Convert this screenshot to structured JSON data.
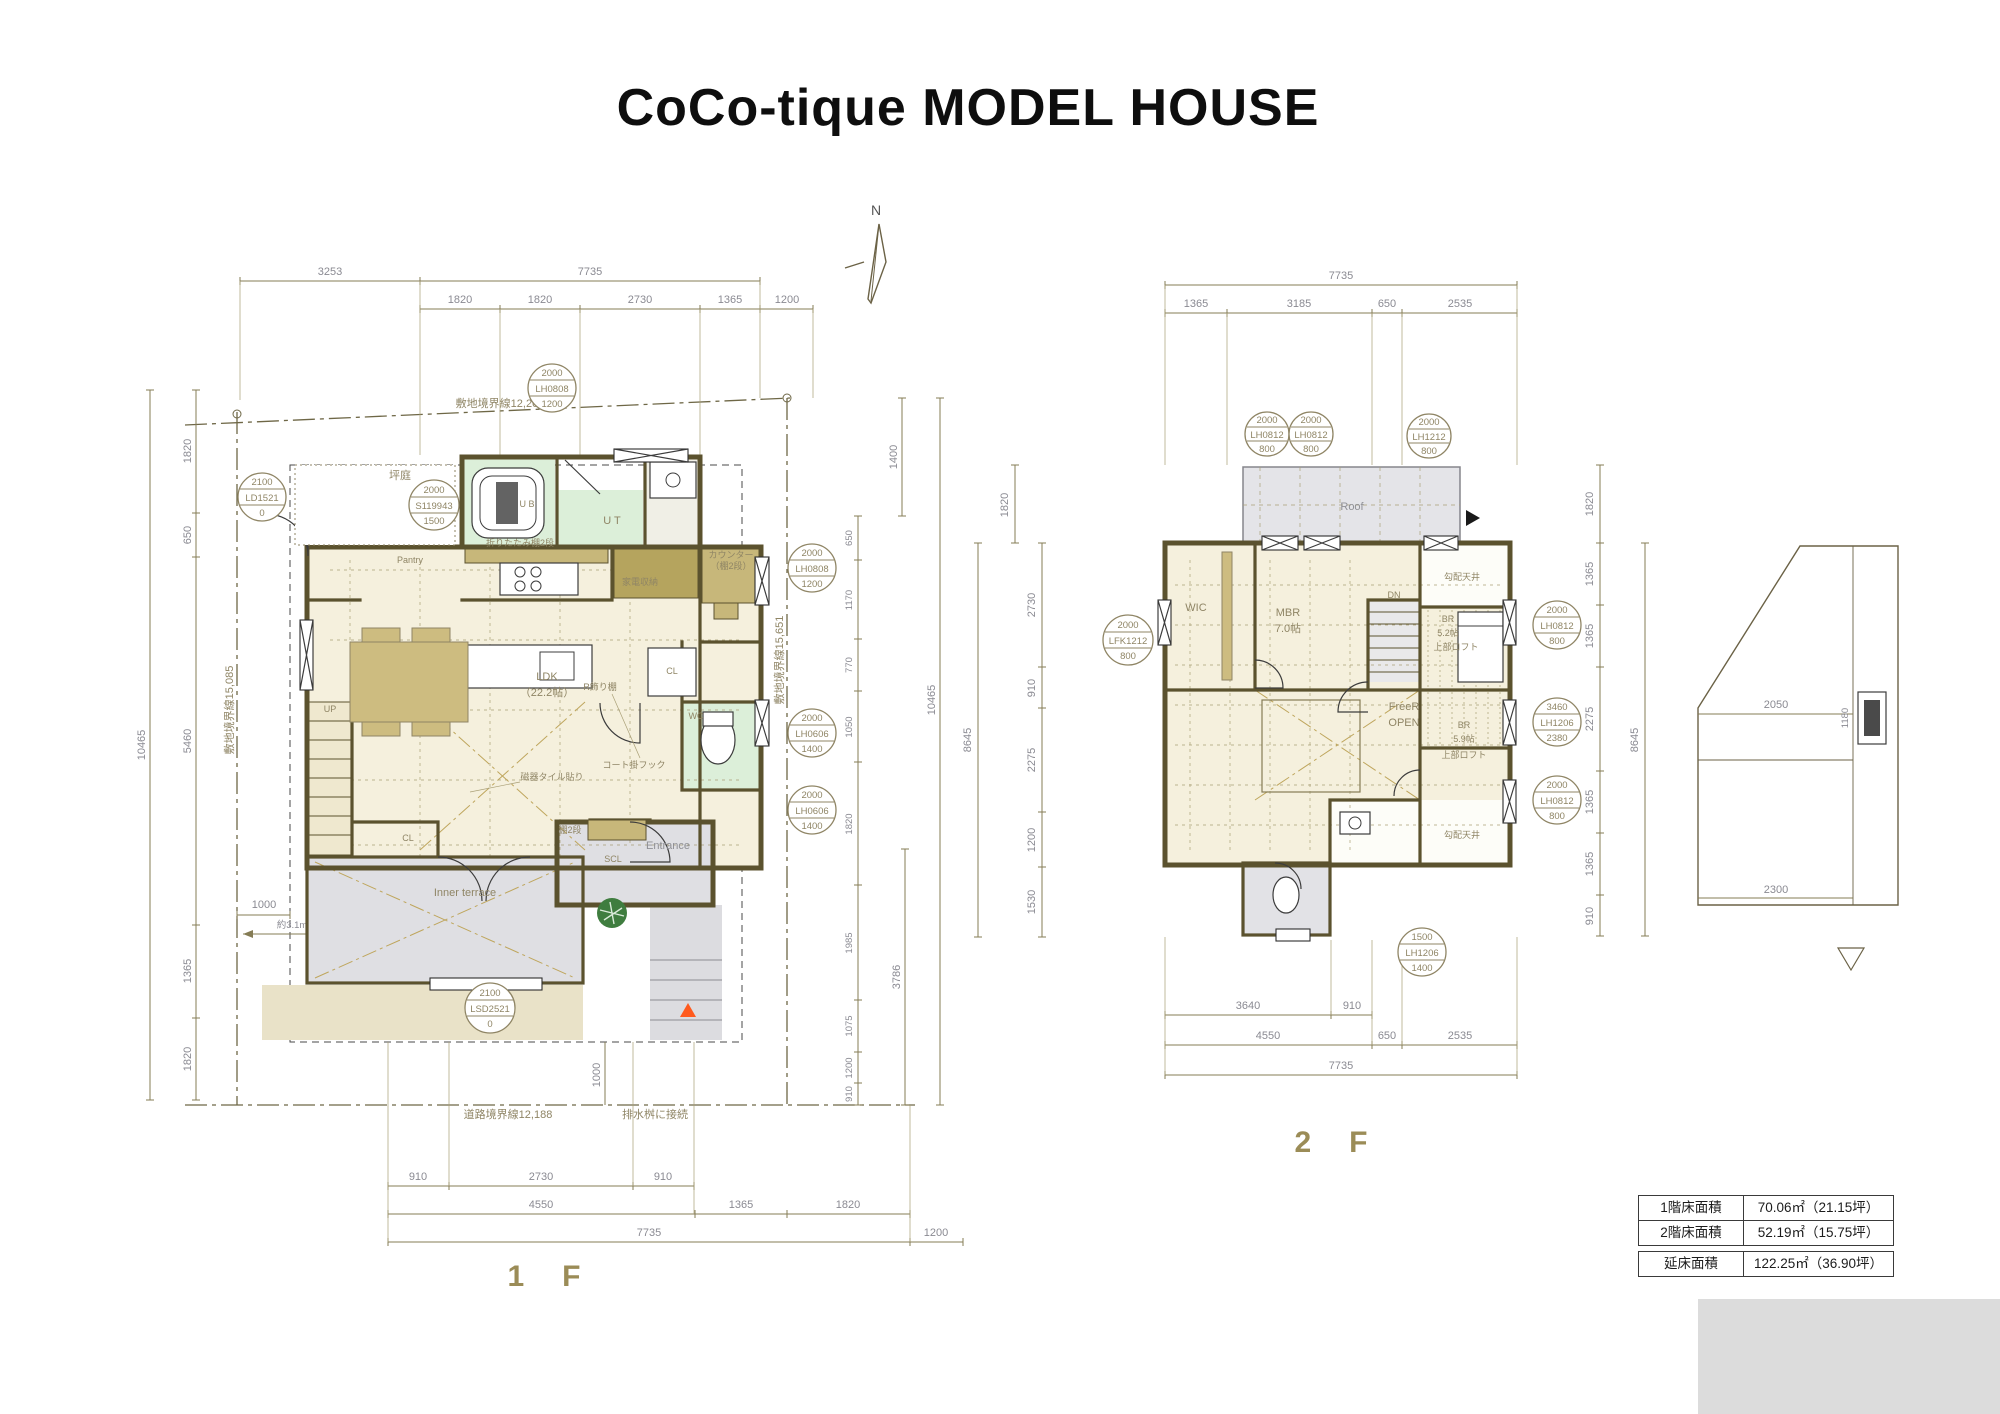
{
  "title": "CoCo-tique  MODEL HOUSE",
  "north": "N",
  "floor1": {
    "caption": "1　F",
    "boundaries": {
      "top": "敷地境界線12,203",
      "left": "敷地境界線15,085",
      "right": "敷地境界線15,651",
      "bottom": "道路境界線12,188",
      "drain": "排水桝に接続"
    },
    "dims": {
      "top1": [
        "3253",
        "7735"
      ],
      "top2": [
        "1820",
        "1820",
        "2730",
        "1365",
        "1200"
      ],
      "left": [
        "1820",
        "650",
        "5460",
        "1365",
        "1820"
      ],
      "left_total": "10465",
      "right": [
        "650",
        "1170",
        "770",
        "1050",
        "1820",
        "1985",
        "1075",
        "1200",
        "910"
      ],
      "right_top": "1400",
      "right_total": "10465",
      "right_bottom": "3786",
      "bottom1": [
        "910",
        "2730",
        "910"
      ],
      "bottom2": [
        "4550",
        "1365",
        "1820"
      ],
      "bottom3": [
        "7735",
        "1200"
      ],
      "offset_left": "1000",
      "offset_bottom": "1000",
      "approx_w": "約3.1m",
      "approx_h": "約3.7m"
    },
    "windows": [
      {
        "a": "2000",
        "b": "LH0808",
        "c": "1200"
      },
      {
        "a": "2000",
        "b": "S119943",
        "c": "1500"
      },
      {
        "a": "2100",
        "b": "LD1521",
        "c": "0"
      },
      {
        "a": "2000",
        "b": "LH0808",
        "c": "1200"
      },
      {
        "a": "2000",
        "b": "LH0606",
        "c": "1400"
      },
      {
        "a": "2000",
        "b": "LH0606",
        "c": "1400"
      },
      {
        "a": "2100",
        "b": "LSD2521",
        "c": "0"
      }
    ],
    "rooms": {
      "tsuboniwa": "坪庭",
      "ub": "U B",
      "ut": "U T",
      "pantry": "Pantry",
      "kitchen_shelf": "折りたたみ棚2段",
      "kaden": "家電収納",
      "counter1": "カウンター",
      "counter2": "（棚2段）",
      "cl_right": "CL",
      "cl_left": "CL",
      "wc": "WC",
      "ldk": "LDK",
      "ldk_size": "（22.2帖）",
      "r_shelf": "R飾り棚",
      "coat_hook": "コート掛フック",
      "tile": "磁器タイル貼り",
      "entrance": "Entrance",
      "scl": "SCL",
      "terrace": "Inner terrace",
      "shelf2": "棚2段",
      "up": "UP"
    }
  },
  "floor2": {
    "caption": "2　F",
    "dims": {
      "top1": [
        "7735"
      ],
      "top2": [
        "1365",
        "3185",
        "650",
        "2535"
      ],
      "left_outer": "1820",
      "left": [
        "2730",
        "910",
        "2275",
        "1200",
        "1530"
      ],
      "left_total": "8645",
      "right": [
        "1820",
        "1365",
        "1365",
        "2275",
        "1365",
        "1365",
        "910"
      ],
      "right_total": "8645",
      "bottom1": [
        "3640",
        "910"
      ],
      "bottom2": [
        "4550",
        "650",
        "2535"
      ],
      "bottom3": [
        "7735"
      ]
    },
    "windows": [
      {
        "a": "2000",
        "b": "LH0812",
        "c": "800"
      },
      {
        "a": "2000",
        "b": "LH0812",
        "c": "800"
      },
      {
        "a": "2000",
        "b": "LH1212",
        "c": "800"
      },
      {
        "a": "2000",
        "b": "LFK1212",
        "c": "800"
      },
      {
        "a": "2000",
        "b": "LH0812",
        "c": "800"
      },
      {
        "a": "3460",
        "b": "LH1206",
        "c": "2380"
      },
      {
        "a": "2000",
        "b": "LH0812",
        "c": "800"
      },
      {
        "a": "1500",
        "b": "LH1206",
        "c": "1400"
      }
    ],
    "rooms": {
      "roof": "Roof",
      "wic": "WIC",
      "mbr": "MBR",
      "mbr_size": "7.0帖",
      "keisha1": "勾配天井",
      "keisha2": "勾配天井",
      "br1": "BR",
      "br1_size": "5.2帖",
      "br1_loft": "上部ロフト",
      "br2": "BR",
      "br2_size": "5.9帖",
      "br2_loft": "上部ロフト",
      "freer": "FreeR",
      "open": "OPEN",
      "dn": "DN"
    }
  },
  "elevation": {
    "width": "2050",
    "window": "1180",
    "bottom": "2300"
  },
  "area_table": {
    "rows": [
      {
        "label": "1階床面積",
        "value": "70.06㎡（21.15坪）"
      },
      {
        "label": "2階床面積",
        "value": "52.19㎡（15.75坪）"
      },
      {
        "label": "延床面積",
        "value": "122.25㎡（36.90坪）"
      }
    ]
  }
}
